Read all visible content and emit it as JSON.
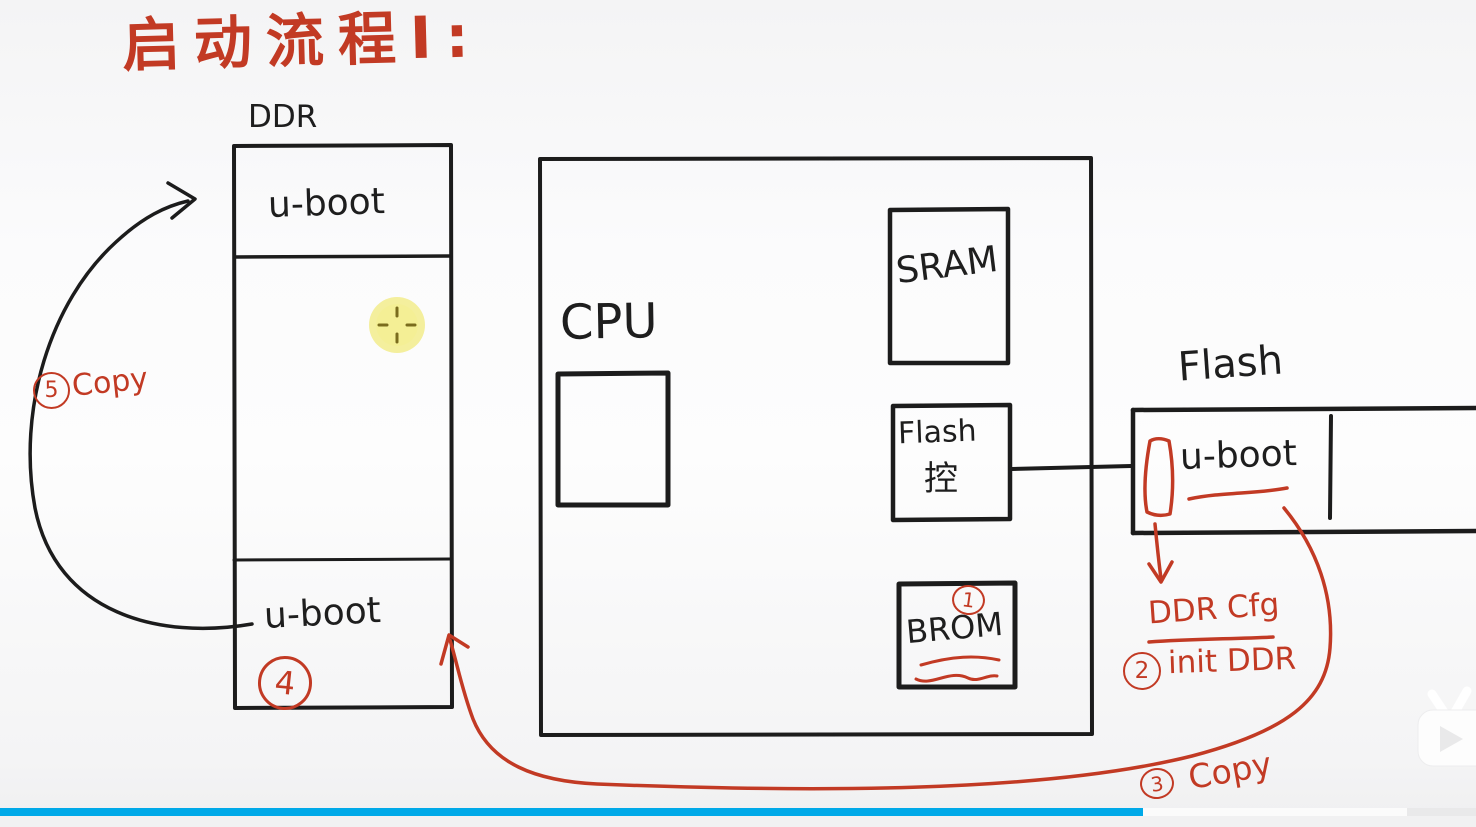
{
  "title": "启动流程Ⅰ:",
  "colors": {
    "ink": "#1c1c1c",
    "annotation_red": "#c23a24",
    "progress_blue": "#00a9e8",
    "cursor_highlight_yellow": "#f2ec8c"
  },
  "ddr": {
    "label": "DDR",
    "top_block": "u-boot",
    "bottom_block": "u-boot",
    "step_badge": "4"
  },
  "soc": {
    "cpu_label": "CPU",
    "sram_label": "SRAM",
    "flash_controller": {
      "line1": "Flash",
      "line2": "控"
    },
    "brom": {
      "label": "BROM",
      "step_badge": "1"
    }
  },
  "flash": {
    "label": "Flash",
    "block": "u-boot"
  },
  "steps": {
    "step1": {
      "badge": "1"
    },
    "step2": {
      "badge": "2",
      "note_line1": "DDR Cfg",
      "note_line2": "init DDR"
    },
    "step3": {
      "badge": "3",
      "text": "Copy"
    },
    "step4": {
      "badge": "4"
    },
    "step5": {
      "badge": "5",
      "text": "Copy"
    }
  },
  "player": {
    "progress_percent": 77
  }
}
